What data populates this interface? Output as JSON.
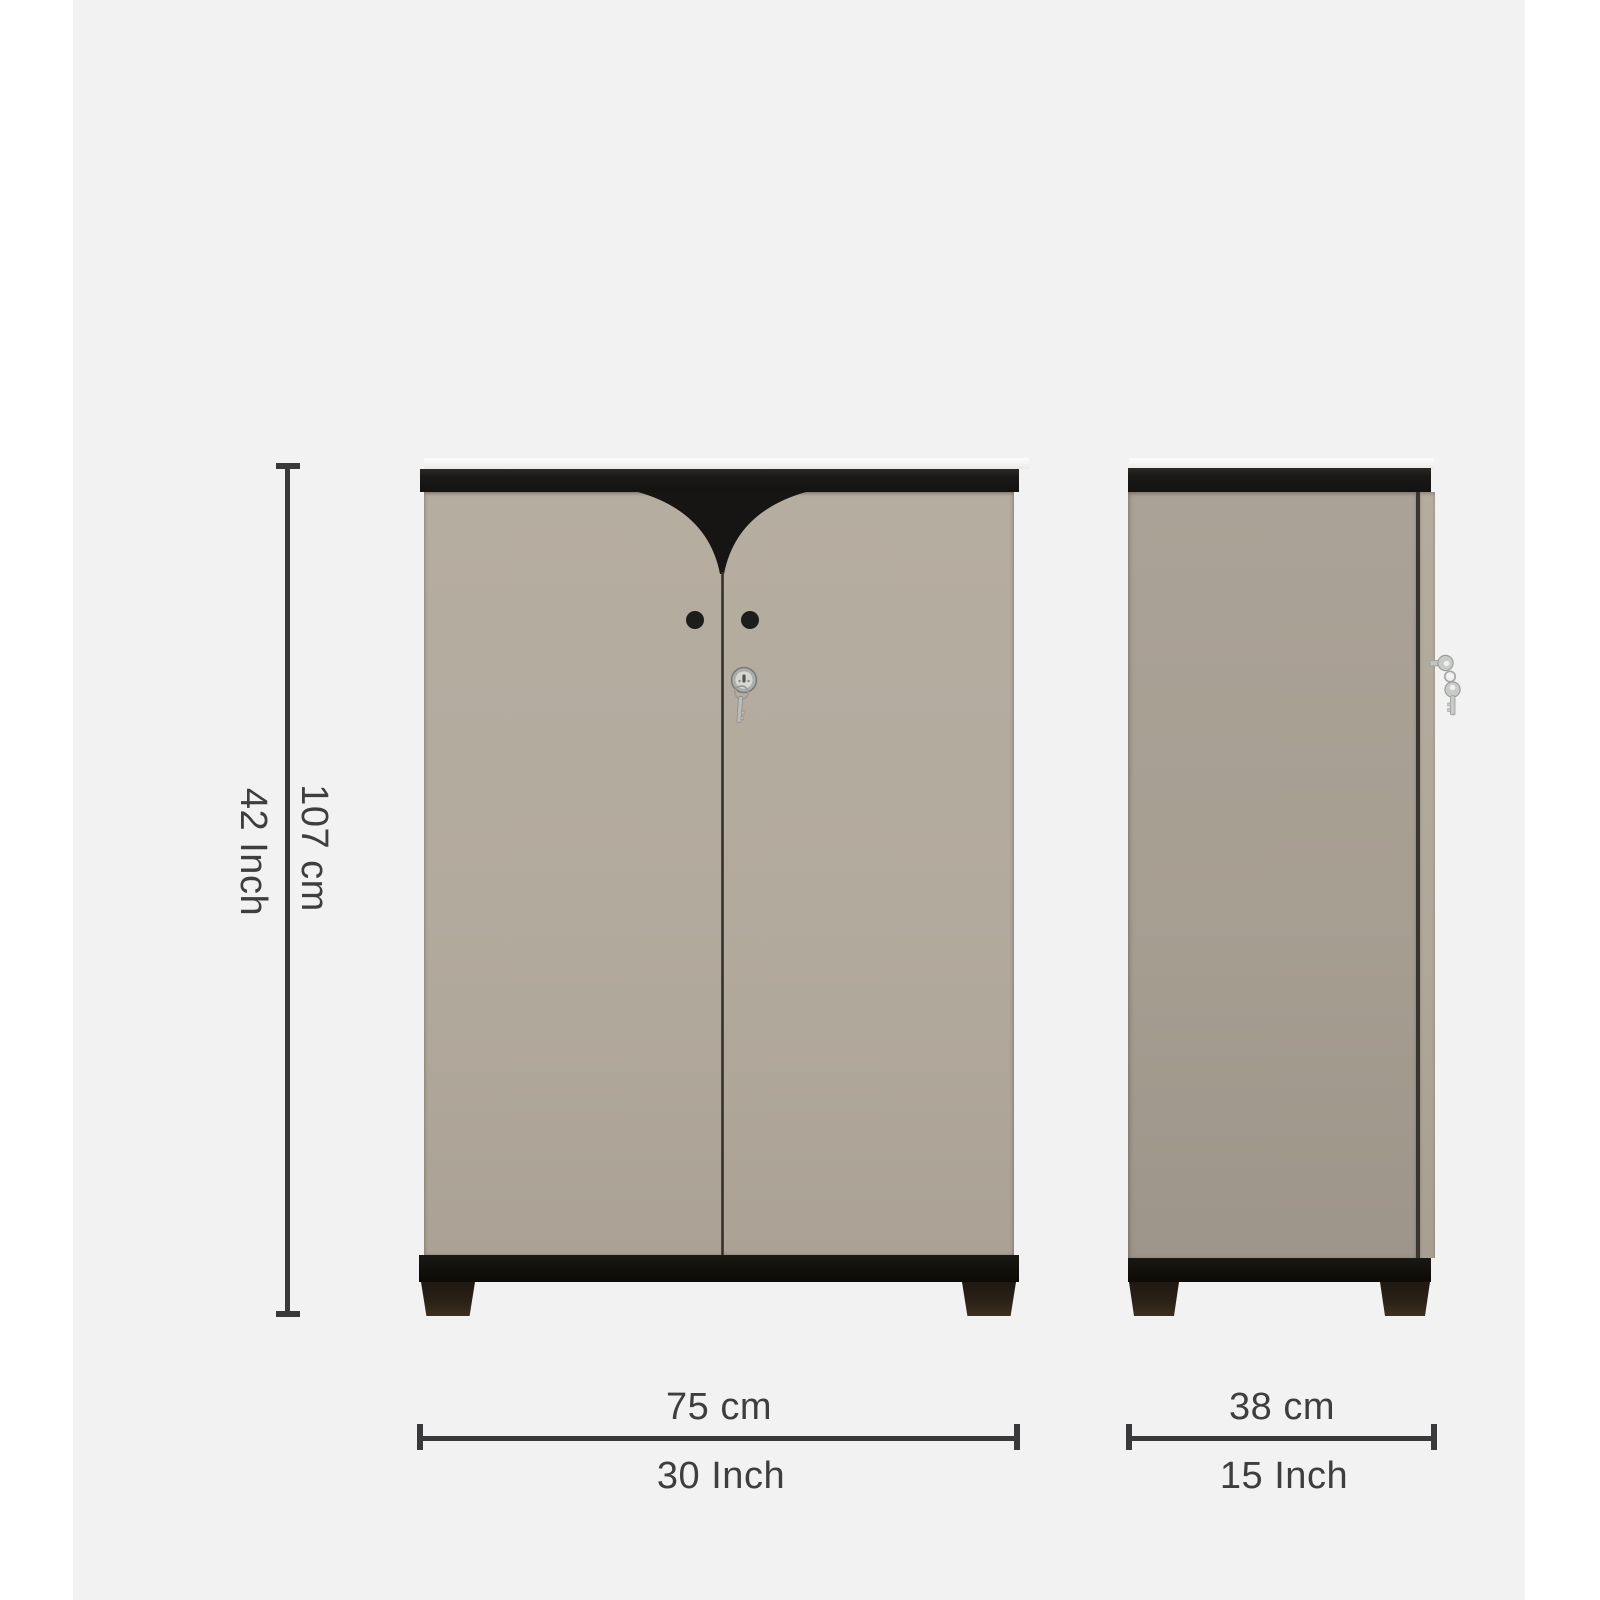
{
  "dimensions": {
    "height": {
      "inch_label": "42 Inch",
      "cm_label": "107 cm"
    },
    "width": {
      "cm_label": "75 cm",
      "inch_label": "30 Inch"
    },
    "depth": {
      "cm_label": "38 cm",
      "inch_label": "15 Inch"
    }
  },
  "colors": {
    "page_background": "#ffffff",
    "canvas_background": "#f2f2f2",
    "cabinet_door": "#b4ab9f",
    "cabinet_side_panel": "#a79e92",
    "cabinet_trim_black": "#1b1917",
    "cabinet_base_black": "#121009",
    "foot_brown": "#32261a",
    "dimension_line": "#39393b",
    "label_text": "#3e3e40",
    "metal_silver": "#c7c9c6"
  },
  "icons": {
    "lock": "lock-icon",
    "front_hanging_key": "key-icon",
    "side_keys": "keys-icon",
    "door_knobs": "door-knob"
  }
}
